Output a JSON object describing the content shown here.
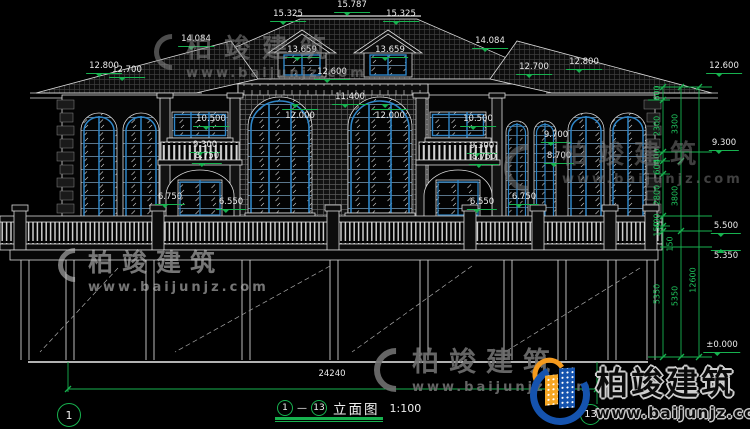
{
  "drawing": {
    "view_title": "立面图",
    "scale_label": "1:100",
    "axis_start": "1",
    "axis_end": "13",
    "separator": "—"
  },
  "watermark": {
    "company": "柏竣建筑",
    "website": "www.baijunjz.com"
  },
  "logo": {
    "company": "柏竣建筑",
    "website": "www.baijunjz.com"
  },
  "colors": {
    "dim_green": "#17b24f",
    "window_blue": "#2f86c8",
    "logo_blue": "#1553ae",
    "logo_orange": "#f59a1d"
  },
  "elevation_labels": [
    {
      "t": "15.787",
      "x": 352,
      "y": 1
    },
    {
      "t": "15.325",
      "x": 288,
      "y": 10
    },
    {
      "t": "15.325",
      "x": 401,
      "y": 10
    },
    {
      "t": "13.659",
      "x": 302,
      "y": 46
    },
    {
      "t": "13.659",
      "x": 390,
      "y": 46
    },
    {
      "t": "14.084",
      "x": 196,
      "y": 35
    },
    {
      "t": "14.084",
      "x": 490,
      "y": 37
    },
    {
      "t": "12.800",
      "x": 104,
      "y": 62
    },
    {
      "t": "12.700",
      "x": 127,
      "y": 66
    },
    {
      "t": "12.700",
      "x": 534,
      "y": 63
    },
    {
      "t": "12.800",
      "x": 584,
      "y": 58
    },
    {
      "t": "12.600",
      "x": 332,
      "y": 68
    },
    {
      "t": "11.400",
      "x": 350,
      "y": 93
    },
    {
      "t": "12.000",
      "x": 300,
      "y": 109,
      "cls": "m-top"
    },
    {
      "t": "12.000",
      "x": 390,
      "y": 109,
      "cls": "m-top"
    },
    {
      "t": "10.500",
      "x": 211,
      "y": 115
    },
    {
      "t": "10.500",
      "x": 478,
      "y": 115
    },
    {
      "t": "9.300",
      "x": 205,
      "y": 141
    },
    {
      "t": "8.750",
      "x": 207,
      "y": 152
    },
    {
      "t": "9.300",
      "x": 482,
      "y": 142
    },
    {
      "t": "8.750",
      "x": 484,
      "y": 153
    },
    {
      "t": "9.700",
      "x": 556,
      "y": 131
    },
    {
      "t": "8.700",
      "x": 559,
      "y": 152
    },
    {
      "t": "6.750",
      "x": 170,
      "y": 193
    },
    {
      "t": "6.550",
      "x": 231,
      "y": 198
    },
    {
      "t": "6.550",
      "x": 482,
      "y": 198
    },
    {
      "t": "6.750",
      "x": 524,
      "y": 193
    },
    {
      "t": "12.600",
      "x": 724,
      "y": 62
    },
    {
      "t": "9.300",
      "x": 724,
      "y": 139
    },
    {
      "t": "5.500",
      "x": 726,
      "y": 222
    },
    {
      "t": "5.350",
      "x": 726,
      "y": 250,
      "cls": "m-up"
    },
    {
      "t": "±0.000",
      "x": 722,
      "y": 341
    },
    {
      "t": "24240",
      "x": 332,
      "y": 370,
      "cls": "plain"
    }
  ],
  "chain_labels": [
    {
      "t": "600",
      "x": 657,
      "y": 93
    },
    {
      "t": "2300",
      "x": 657,
      "y": 126
    },
    {
      "t": "400",
      "x": 657,
      "y": 156
    },
    {
      "t": "600",
      "x": 657,
      "y": 167
    },
    {
      "t": "2800",
      "x": 657,
      "y": 195
    },
    {
      "t": "400",
      "x": 657,
      "y": 221
    },
    {
      "t": "150",
      "x": 657,
      "y": 229
    },
    {
      "t": "5350",
      "x": 657,
      "y": 294
    },
    {
      "t": "3300",
      "x": 675,
      "y": 124
    },
    {
      "t": "3800",
      "x": 675,
      "y": 196
    },
    {
      "t": "150",
      "x": 670,
      "y": 244
    },
    {
      "t": "5350",
      "x": 675,
      "y": 296
    },
    {
      "t": "12600",
      "x": 693,
      "y": 280
    }
  ]
}
